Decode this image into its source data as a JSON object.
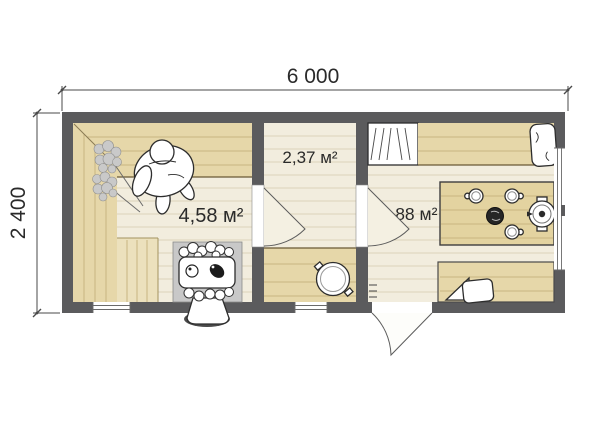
{
  "plan": {
    "type": "bath-house floor plan",
    "dimensions": {
      "width_label": "6 000",
      "height_label": "2 400"
    },
    "rooms": {
      "steam_room": {
        "area_label": "4,58 м²"
      },
      "washing_room": {
        "area_label": "2,37 м²"
      },
      "rest_room": {
        "area_label": "4,88 м²"
      }
    }
  },
  "colors": {
    "wall": "#5b5b5d",
    "floor": "#f2edde",
    "floor_line": "#dcd4ba",
    "wood": "#e6d7a9",
    "wood_light": "#ece1bd",
    "wood_line": "#c8b581",
    "wood_edge": "#6a5a36",
    "stove_niche": "#c8c8c8",
    "door_fill": "#f4f0e2",
    "dim": "#4a4a4a",
    "text": "#2a2a2a"
  }
}
